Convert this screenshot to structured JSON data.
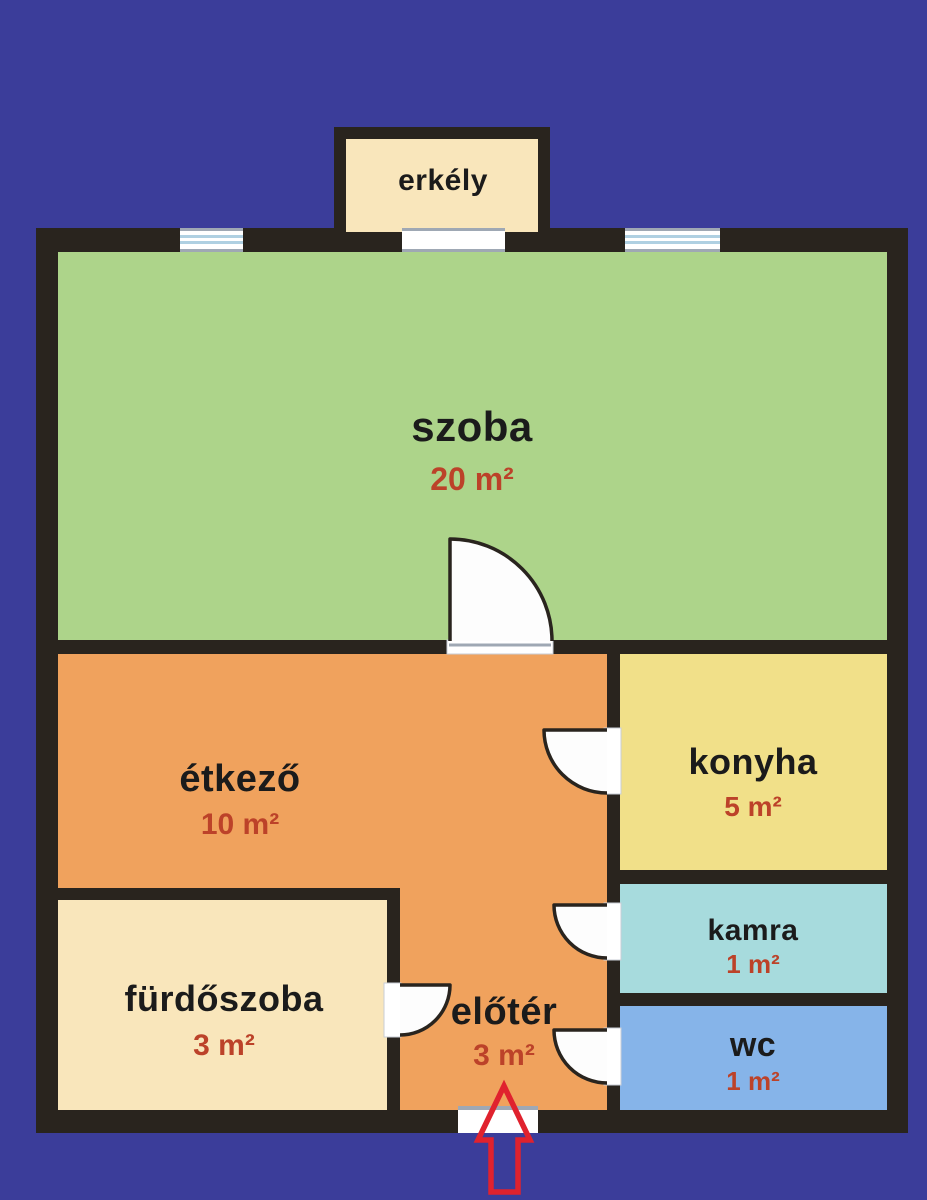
{
  "floorplan": {
    "colors": {
      "background": "#3B3D9A",
      "wall": "#29241E",
      "area_label": "#BC4229",
      "entrance_arrow": "#E0222E"
    },
    "rooms": [
      {
        "id": "erkely",
        "name": "erkély",
        "area": ""
      },
      {
        "id": "szoba",
        "name": "szoba",
        "area": "20 m²",
        "color": "#ADD48A"
      },
      {
        "id": "etkezo",
        "name": "étkező",
        "area": "10 m²",
        "color": "#F0A25D"
      },
      {
        "id": "konyha",
        "name": "konyha",
        "area": "5 m²",
        "color": "#F1E089"
      },
      {
        "id": "kamra",
        "name": "kamra",
        "area": "1 m²",
        "color": "#A7DBDD"
      },
      {
        "id": "wc",
        "name": "wc",
        "area": "1 m²",
        "color": "#86B4E9"
      },
      {
        "id": "furdoszoba",
        "name": "fürdőszoba",
        "area": "3 m²",
        "color": "#F9E6BB"
      },
      {
        "id": "eloter",
        "name": "előtér",
        "area": "3 m²",
        "color": "#F0A25D"
      }
    ],
    "erkely_color": "#F9E6BB"
  }
}
